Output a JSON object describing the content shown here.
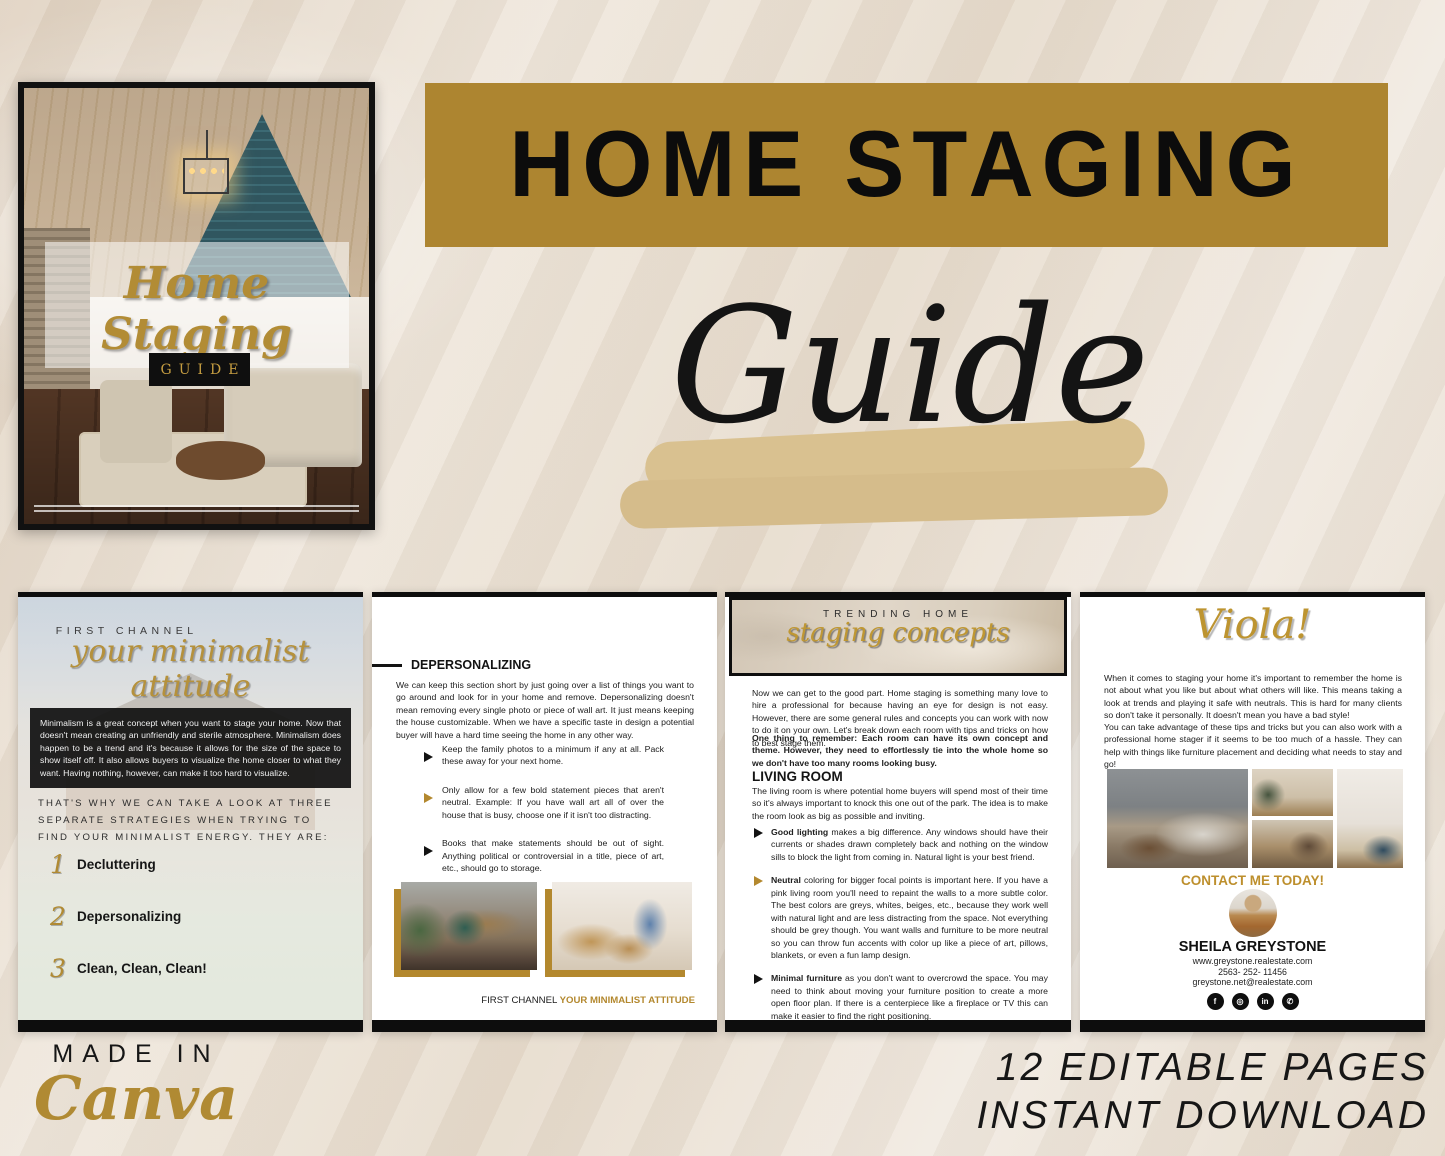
{
  "cover": {
    "script_title": "Home Staging",
    "guide_label": "GUIDE"
  },
  "hero": {
    "title": "HOME STAGING",
    "subtitle_script": "Guide"
  },
  "pages": {
    "page1": {
      "eyebrow": "FIRST CHANNEL",
      "script_title": "your minimalist attitude",
      "intro": "Minimalism is a great concept when you want to stage your home. Now that doesn't mean creating an unfriendly and sterile atmosphere. Minimalism does happen to be a trend and it's because it allows for the size of the space to show itself off. It also allows buyers to visualize the home closer to what they want. Having nothing, however, can make it too hard to visualize.",
      "strategies_lead": "THAT'S WHY WE CAN TAKE A LOOK AT THREE SEPARATE STRATEGIES WHEN TRYING TO FIND YOUR MINIMALIST ENERGY. THEY ARE:",
      "items": [
        {
          "num": "1",
          "label": "Decluttering"
        },
        {
          "num": "2",
          "label": "Depersonalizing"
        },
        {
          "num": "3",
          "label": "Clean, Clean, Clean!"
        }
      ]
    },
    "page2": {
      "heading": "DEPERSONALIZING",
      "intro": "We can keep this section short by just going over a list of things you want to go around and look for in your home and remove. Depersonalizing doesn't mean removing every single photo or piece of wall art. It just means keeping the house customizable. When we have a specific taste in design a potential buyer will have a hard time seeing the home in any other way.",
      "bullets": [
        "Keep the family photos to a minimum if any at all. Pack these away for your next home.",
        "Only allow for a few bold statement pieces that aren't neutral. Example: If you have wall art all of over the house that is busy, choose one if it isn't too distracting.",
        "Books that make statements should be out of sight. Anything political or controversial in a title, piece of art, etc., should go to storage."
      ],
      "footer_black": "FIRST CHANNEL ",
      "footer_gold": "YOUR MINIMALIST ATTITUDE"
    },
    "page3": {
      "banner_eyebrow": "TRENDING HOME",
      "banner_script": "staging concepts",
      "intro": "Now we can get to the good part. Home staging is something many love to hire a professional for because having an eye for design is not easy. However, there are some general rules and concepts you can work with now to do it on your own. Let's break down each room with tips and tricks on how to best stage them.",
      "remember": "One thing to remember: Each room can have its own concept and theme. However, they need to effortlessly tie into the whole home so we don't have too many rooms looking busy.",
      "section_heading": "LIVING ROOM",
      "section_intro": "The living room is where potential home buyers will spend most of their time so it's always important to knock this one out of the park. The idea is to make the room look as big as possible and inviting.",
      "bullets": [
        {
          "bold": "Good lighting",
          "text": " makes a big difference. Any windows should have their currents or shades drawn completely back and nothing on the window sills to block the light from coming in. Natural light is your best friend."
        },
        {
          "bold": "Neutral",
          "text": " coloring for bigger focal points is important here. If you have a pink living room you'll need to repaint the walls to a more subtle color. The best colors are greys, whites, beiges, etc., because they work well with natural light and are less distracting from the space. Not everything should be grey though. You want walls and furniture to be more neutral so you can throw fun accents with color up like a piece of art, pillows, blankets, or even a fun lamp design."
        },
        {
          "bold": "Minimal furniture",
          "text": " as you don't want to overcrowd the space. You may need to think about moving your furniture position to create a more open floor plan. If there is a centerpiece like a fireplace or TV this can make it easier to find the right positioning."
        }
      ]
    },
    "page4": {
      "script_title": "Viola!",
      "para1": "When it comes to staging your home it's important to remember the home is not about what you like but about what others will like. This means taking a look at trends and playing it safe with neutrals. This is hard for many clients so don't take it personally. It doesn't mean you have a bad style!",
      "para2": "You can take advantage of these tips and tricks but you can also work with a professional home stager if it seems to be too much of a hassle. They can help with things like furniture placement and deciding what needs to stay and go!",
      "contact_heading": "CONTACT ME TODAY!",
      "agent_name": "SHEILA GREYSTONE",
      "website": "www.greystone.realestate.com",
      "phone": "2563- 252- 11456",
      "email": "greystone.net@realestate.com",
      "social_icons": [
        {
          "name": "facebook",
          "glyph": "f"
        },
        {
          "name": "instagram",
          "glyph": "◎"
        },
        {
          "name": "linkedin",
          "glyph": "in"
        },
        {
          "name": "whatsapp",
          "glyph": "✆"
        }
      ]
    }
  },
  "footer": {
    "made_in": "MADE IN",
    "canva": "Canva",
    "promo_line1": "12 EDITABLE PAGES",
    "promo_line2": "INSTANT DOWNLOAD"
  },
  "colors": {
    "gold_bar": "#ad8530",
    "gold_script": "#b5913c",
    "tan_brush": "#d9c190",
    "page_black": "#0d0d0d",
    "background": "#ebe1d4"
  }
}
